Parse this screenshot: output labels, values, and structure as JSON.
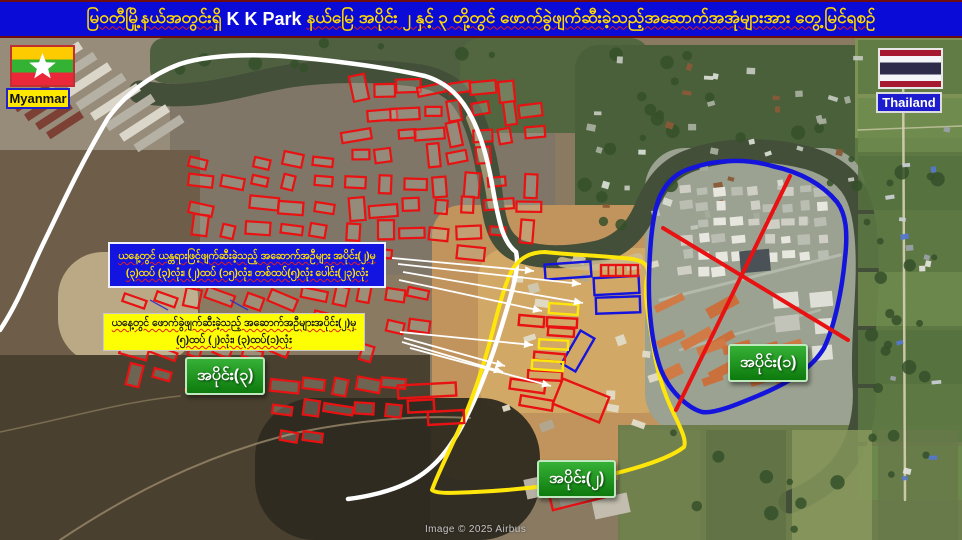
{
  "title": {
    "part1": "မြဝတီမြို့နယ်အတွင်းရှိ",
    "part2": "K K Park",
    "part3": "နယ်မြေ အပိုင်း ၂ နှင့် ၃ တို့တွင် ဖောက်ခွဲဖျက်ဆီးခဲ့သည့်အဆောက်အအုံများအား တွေ့မြင်ရစဉ်",
    "full": "မြဝတီမြို့နယ်အတွင်းရှိ K K Park နယ်မြေ အပိုင်း ၂ နှင့် ၃ တို့တွင် ဖောက်ခွဲဖျက်ဆီးခဲ့သည့်အဆောက်အအုံများအား တွေ့မြင်ရစဉ်"
  },
  "flags": {
    "myanmar": {
      "label": "Myanmar"
    },
    "thailand": {
      "label": "Thailand"
    }
  },
  "callouts": {
    "blue_box": {
      "line1": "ယနေ့တွင် ယန္တရားဖြင့်ဖျက်ဆီးခဲ့သည့် အဆောက်အဦများ အပိုင်း(၂)မှ",
      "line2": "(၃)ထပ် (၃)လုံး၊ (၂)ထပ် (၁၅)လုံး၊ တစ်ထပ်(၅)လုံး ပေါင်း(၂၃)လုံး"
    },
    "yellow_box": {
      "line1": "ယနေ့တွင် ဖောက်ခွဲဖျက်ဆီးခဲ့သည့် အဆောက်အဦများအပိုင်း(၂)မှ",
      "line2": "(၅)ထပ် (၂)လုံး၊ (၃)ထပ်(၁)လုံး"
    }
  },
  "regions": {
    "section1": {
      "label": "အပိုင်း(၁)"
    },
    "section2": {
      "label": "အပိုင်း(၂)"
    },
    "section3": {
      "label": "အပိုင်း(၃)"
    }
  },
  "attribution": "Image © 2025 Airbus",
  "colors": {
    "title_bg": "#0b0bd8",
    "title_text": "#ffd800",
    "annotation_red": "#e81212",
    "annotation_blue": "#1414dd",
    "annotation_yellow": "#ffe60a",
    "annotation_white": "#ffffff",
    "label_green": "#1d941d",
    "callout_blue_bg": "#1414e0",
    "callout_yellow_bg": "#fdfd04"
  },
  "map": {
    "base_color": "#8a7a62",
    "patches": [
      [
        0,
        38,
        230,
        140,
        0,
        "#978b7a",
        1
      ],
      [
        170,
        60,
        385,
        215,
        18,
        "#7e7567",
        0.92
      ],
      [
        0,
        150,
        200,
        270,
        0,
        "#6e5e49",
        1
      ],
      [
        150,
        38,
        360,
        45,
        14,
        "#4e6040",
        1
      ],
      [
        460,
        38,
        190,
        95,
        20,
        "#52663f",
        1
      ],
      [
        575,
        45,
        305,
        195,
        24,
        "#49603a",
        1
      ],
      [
        855,
        38,
        107,
        470,
        0,
        "#5e7843",
        1
      ],
      [
        855,
        38,
        107,
        100,
        0,
        "#7c9355",
        1
      ],
      [
        58,
        252,
        140,
        112,
        45,
        "#c2b18b",
        0.9
      ],
      [
        0,
        355,
        430,
        185,
        0,
        "#49402f",
        1
      ],
      [
        432,
        205,
        282,
        275,
        30,
        "#c0945c",
        1
      ],
      [
        478,
        248,
        195,
        165,
        30,
        "#d2a867",
        1
      ],
      [
        255,
        398,
        285,
        142,
        60,
        "#2e2a20",
        0.95
      ],
      [
        645,
        148,
        220,
        285,
        40,
        "#9ba291",
        1
      ],
      [
        618,
        425,
        344,
        115,
        0,
        "#6d7d4c",
        1
      ]
    ],
    "river": {
      "d": "M 140,92 C 200,102 240,84 290,76 C 330,70 380,70 420,76 C 448,81 462,95 470,112 C 482,136 488,168 492,200 C 495,225 500,245 522,252 C 545,259 570,258 598,252 C 622,246 636,230 645,210 C 655,185 668,168 692,160 C 725,148 770,148 808,158 C 832,165 850,178 858,198 C 866,218 868,248 867,280 C 866,315 862,350 864,385 C 866,412 860,440 845,462 C 832,480 812,494 790,502",
      "color": "#434f39",
      "width": 23
    },
    "sand": [
      {
        "d": "M 470,118 C 480,142 487,172 492,206",
        "color": "#c7b489",
        "width": 8,
        "op": 0.7
      },
      {
        "d": "M 562,262 C 585,268 615,266 638,258",
        "color": "#cbbc92",
        "width": 10,
        "op": 0.85
      }
    ],
    "roads": [
      {
        "d": "M 60,540 C 120,500 200,455 300,432 C 360,420 420,415 470,418",
        "color": "#9b8a6b",
        "width": 2,
        "op": 0.8
      },
      {
        "d": "M 0,432 C 60,420 120,402 180,396",
        "color": "#9b8a6b",
        "width": 1.5,
        "op": 0.6
      },
      {
        "d": "M 903,50 L 905,500",
        "color": "#d6d0b2",
        "width": 2.5,
        "op": 0.9
      },
      {
        "d": "M 858,130 L 962,126",
        "color": "#d6d0b2",
        "width": 1.5,
        "op": 0.7
      },
      {
        "d": "M 660,300 L 840,255",
        "color": "#b9bfb2",
        "width": 3,
        "op": 0.8
      },
      {
        "d": "M 680,350 L 820,310",
        "color": "#b9bfb2",
        "width": 2.5,
        "op": 0.7
      }
    ],
    "field_strips": {
      "x": 858,
      "y": 40,
      "w": 104,
      "h": 54,
      "count": 8,
      "colors": [
        "#5d7843",
        "#6d8a4c",
        "#55713e"
      ]
    },
    "br_strips": {
      "x": 620,
      "y": 430,
      "w": 80,
      "h": 110,
      "count": 4,
      "colors": [
        "#72824e",
        "#5f7244",
        "#8a9a5e",
        "#66794a"
      ]
    },
    "tree_areas": [
      {
        "x": 580,
        "y": 50,
        "w": 290,
        "h": 185,
        "n": 24
      },
      {
        "x": 865,
        "y": 140,
        "w": 95,
        "h": 340,
        "n": 18
      },
      {
        "x": 160,
        "y": 40,
        "w": 340,
        "h": 38,
        "n": 10
      },
      {
        "x": 625,
        "y": 430,
        "w": 330,
        "h": 105,
        "n": 12
      }
    ],
    "tree_color": "#35502a",
    "warehouses": {
      "x0": 30,
      "y0": 60,
      "n": 8,
      "dx": 14.5,
      "dy": 10.5,
      "len": 55,
      "h": 9,
      "angle": -33,
      "colors": [
        "#dad6ca",
        "#b5b1a4"
      ]
    },
    "warehouses_red": {
      "x0": 12,
      "y0": 98,
      "n": 4,
      "dx": 11,
      "dy": 9,
      "len": 40,
      "h": 8,
      "angle": -33,
      "color": "#7c4134"
    },
    "scatter_clusters": [
      {
        "x": 590,
        "y": 58,
        "w": 275,
        "h": 170,
        "n": 42,
        "bw": 7,
        "bh": 5,
        "colors": [
          "#d8dcd2",
          "#a7ad9c",
          "#8a5a36",
          "#c2c6bc"
        ],
        "seed": 7
      },
      {
        "x": 888,
        "y": 120,
        "w": 60,
        "h": 360,
        "n": 16,
        "bw": 7,
        "bh": 5,
        "colors": [
          "#e0e2da",
          "#9aa0a8",
          "#5577cc",
          "#c9cdd2"
        ],
        "seed": 11
      },
      {
        "x": 490,
        "y": 258,
        "w": 165,
        "h": 175,
        "n": 16,
        "bw": 10,
        "bh": 7,
        "colors": [
          "#cfc7b2",
          "#e2dcc8",
          "#b1a890"
        ],
        "seed": 13
      }
    ],
    "complex_grid": {
      "x": 678,
      "y": 182,
      "w": 152,
      "h": 98,
      "n": 48,
      "angle": -4,
      "colors": [
        "#e7e7e0",
        "#cfcfc6",
        "#b9bdb2"
      ],
      "seed": 21
    },
    "complex_orange": [
      {
        "x": 658,
        "y": 288,
        "w": 78,
        "h": 100,
        "n": 9,
        "bw": 26,
        "bh": 9,
        "angle": -28,
        "colors": [
          "#c9703d",
          "#d07a45"
        ],
        "seed": 31
      },
      {
        "x": 700,
        "y": 332,
        "w": 100,
        "h": 62,
        "n": 8,
        "bw": 24,
        "bh": 9,
        "angle": -18,
        "colors": [
          "#c9703d",
          "#cf7a45"
        ],
        "seed": 33
      }
    ],
    "complex_gray": {
      "x": 768,
      "y": 286,
      "w": 72,
      "h": 78,
      "n": 6,
      "bw": 20,
      "bh": 13,
      "angle": -8,
      "colors": [
        "#dedfd6",
        "#c2c4ba"
      ],
      "seed": 35
    },
    "complex_dark_roof": [
      740,
      250,
      30,
      22,
      -5,
      "#4a5258"
    ],
    "region2_warehouses": [
      [
        525,
        476,
        36,
        20,
        -12,
        "#b6b1a2"
      ],
      [
        559,
        486,
        36,
        20,
        -12,
        "#8e897b"
      ],
      [
        593,
        496,
        36,
        20,
        -12,
        "#c2bdae"
      ]
    ],
    "red_clusters": [
      {
        "x": 345,
        "y": 78,
        "w": 200,
        "h": 90,
        "n": 30,
        "angle": -6,
        "vfrac": 0.35,
        "seed": 41
      },
      {
        "x": 186,
        "y": 150,
        "w": 150,
        "h": 112,
        "n": 22,
        "angle": 9,
        "vfrac": 0.15,
        "seed": 43
      },
      {
        "x": 342,
        "y": 172,
        "w": 200,
        "h": 95,
        "n": 26,
        "angle": 0,
        "vfrac": 0.3,
        "seed": 45
      },
      {
        "x": 118,
        "y": 286,
        "w": 180,
        "h": 105,
        "n": 22,
        "angle": 18,
        "vfrac": 0.1,
        "seed": 47
      },
      {
        "x": 305,
        "y": 282,
        "w": 125,
        "h": 85,
        "n": 14,
        "angle": 12,
        "vfrac": 0.2,
        "seed": 49
      },
      {
        "x": 272,
        "y": 372,
        "w": 135,
        "h": 75,
        "n": 12,
        "angle": 8,
        "vfrac": 0.15,
        "seed": 51
      }
    ],
    "blue_marks": [
      [
        150,
        300,
        168,
        310
      ],
      [
        185,
        315,
        203,
        325
      ],
      [
        210,
        330,
        228,
        340
      ],
      [
        160,
        340,
        178,
        350
      ],
      [
        230,
        300,
        248,
        310
      ],
      [
        250,
        340,
        268,
        350
      ]
    ],
    "annotations": {
      "white_line": "M 0,330 C 20,300 30,270 45,240 C 62,205 80,165 108,118 C 125,95 150,75 180,64 C 205,56 240,54 280,56 C 320,59 380,66 425,76 C 448,83 462,98 472,118 C 483,140 489,165 494,195 C 499,222 503,242 516,252 C 520,268 512,292 502,325 C 492,358 480,390 465,420 C 450,450 432,472 405,484 C 388,492 365,497 348,499",
      "yellow_region": "M 545,252 C 570,255 610,256 632,259 C 645,261 650,266 647,278 C 644,295 648,315 652,338 C 655,360 660,385 673,412 C 680,427 687,440 684,447 C 670,458 640,468 600,477 C 565,484 520,490 475,492 C 455,493 436,494 432,490 C 436,478 446,458 456,436 C 468,410 480,378 489,345 C 497,315 503,288 512,270 C 520,257 532,252 545,252 Z",
      "blue_region": "M 692,168 C 715,160 745,158 772,166 C 800,172 822,184 837,202 C 846,214 848,232 845,258 C 842,290 835,325 824,348 C 812,368 790,382 762,394 C 738,404 715,414 702,412 C 688,408 670,392 661,370 C 652,345 648,310 649,275 C 650,245 652,215 660,196 C 668,180 678,172 692,168 Z",
      "red_x": [
        [
          790,
          176,
          676,
          410
        ],
        [
          663,
          228,
          848,
          340
        ]
      ],
      "boxes": [
        {
          "x": 545,
          "y": 263,
          "w": 46,
          "h": 15,
          "a": -4,
          "c": "blue"
        },
        {
          "x": 594,
          "y": 277,
          "w": 45,
          "h": 17,
          "a": -3,
          "c": "blue"
        },
        {
          "x": 596,
          "y": 297,
          "w": 44,
          "h": 16,
          "a": -2,
          "c": "blue"
        },
        {
          "x": 570,
          "y": 332,
          "w": 16,
          "h": 38,
          "a": 30,
          "c": "blue"
        },
        {
          "x": 601,
          "y": 265,
          "w": 37,
          "h": 11,
          "a": 0,
          "c": "red",
          "div": 4
        },
        {
          "x": 519,
          "y": 316,
          "w": 25,
          "h": 10,
          "a": 5,
          "c": "red"
        },
        {
          "x": 547,
          "y": 318,
          "w": 30,
          "h": 9,
          "a": 3,
          "c": "red"
        },
        {
          "x": 548,
          "y": 328,
          "w": 26,
          "h": 8,
          "a": 4,
          "c": "red"
        },
        {
          "x": 534,
          "y": 353,
          "w": 31,
          "h": 8,
          "a": 5,
          "c": "red"
        },
        {
          "x": 528,
          "y": 371,
          "w": 34,
          "h": 9,
          "a": 3,
          "c": "red"
        },
        {
          "x": 510,
          "y": 381,
          "w": 35,
          "h": 10,
          "a": 8,
          "c": "red"
        },
        {
          "x": 520,
          "y": 398,
          "w": 33,
          "h": 10,
          "a": 10,
          "c": "red"
        },
        {
          "x": 556,
          "y": 387,
          "w": 50,
          "h": 27,
          "a": 22,
          "c": "red"
        },
        {
          "x": 398,
          "y": 384,
          "w": 58,
          "h": 13,
          "a": -3,
          "c": "red"
        },
        {
          "x": 408,
          "y": 400,
          "w": 26,
          "h": 12,
          "a": -3,
          "c": "red"
        },
        {
          "x": 428,
          "y": 411,
          "w": 36,
          "h": 13,
          "a": -3,
          "c": "red"
        },
        {
          "x": 548,
          "y": 470,
          "w": 55,
          "h": 34,
          "a": -14,
          "c": "red"
        },
        {
          "x": 549,
          "y": 304,
          "w": 29,
          "h": 10,
          "a": 4,
          "c": "yellow"
        },
        {
          "x": 539,
          "y": 340,
          "w": 29,
          "h": 9,
          "a": 3,
          "c": "yellow"
        },
        {
          "x": 532,
          "y": 361,
          "w": 31,
          "h": 9,
          "a": 4,
          "c": "yellow"
        }
      ],
      "arrows": [
        [
          392,
          258,
          534,
          271
        ],
        [
          398,
          264,
          581,
          284
        ],
        [
          403,
          272,
          583,
          303
        ],
        [
          399,
          280,
          542,
          311
        ],
        [
          400,
          332,
          533,
          345
        ],
        [
          404,
          338,
          505,
          366
        ],
        [
          402,
          342,
          503,
          372
        ],
        [
          410,
          348,
          551,
          386
        ]
      ]
    }
  }
}
